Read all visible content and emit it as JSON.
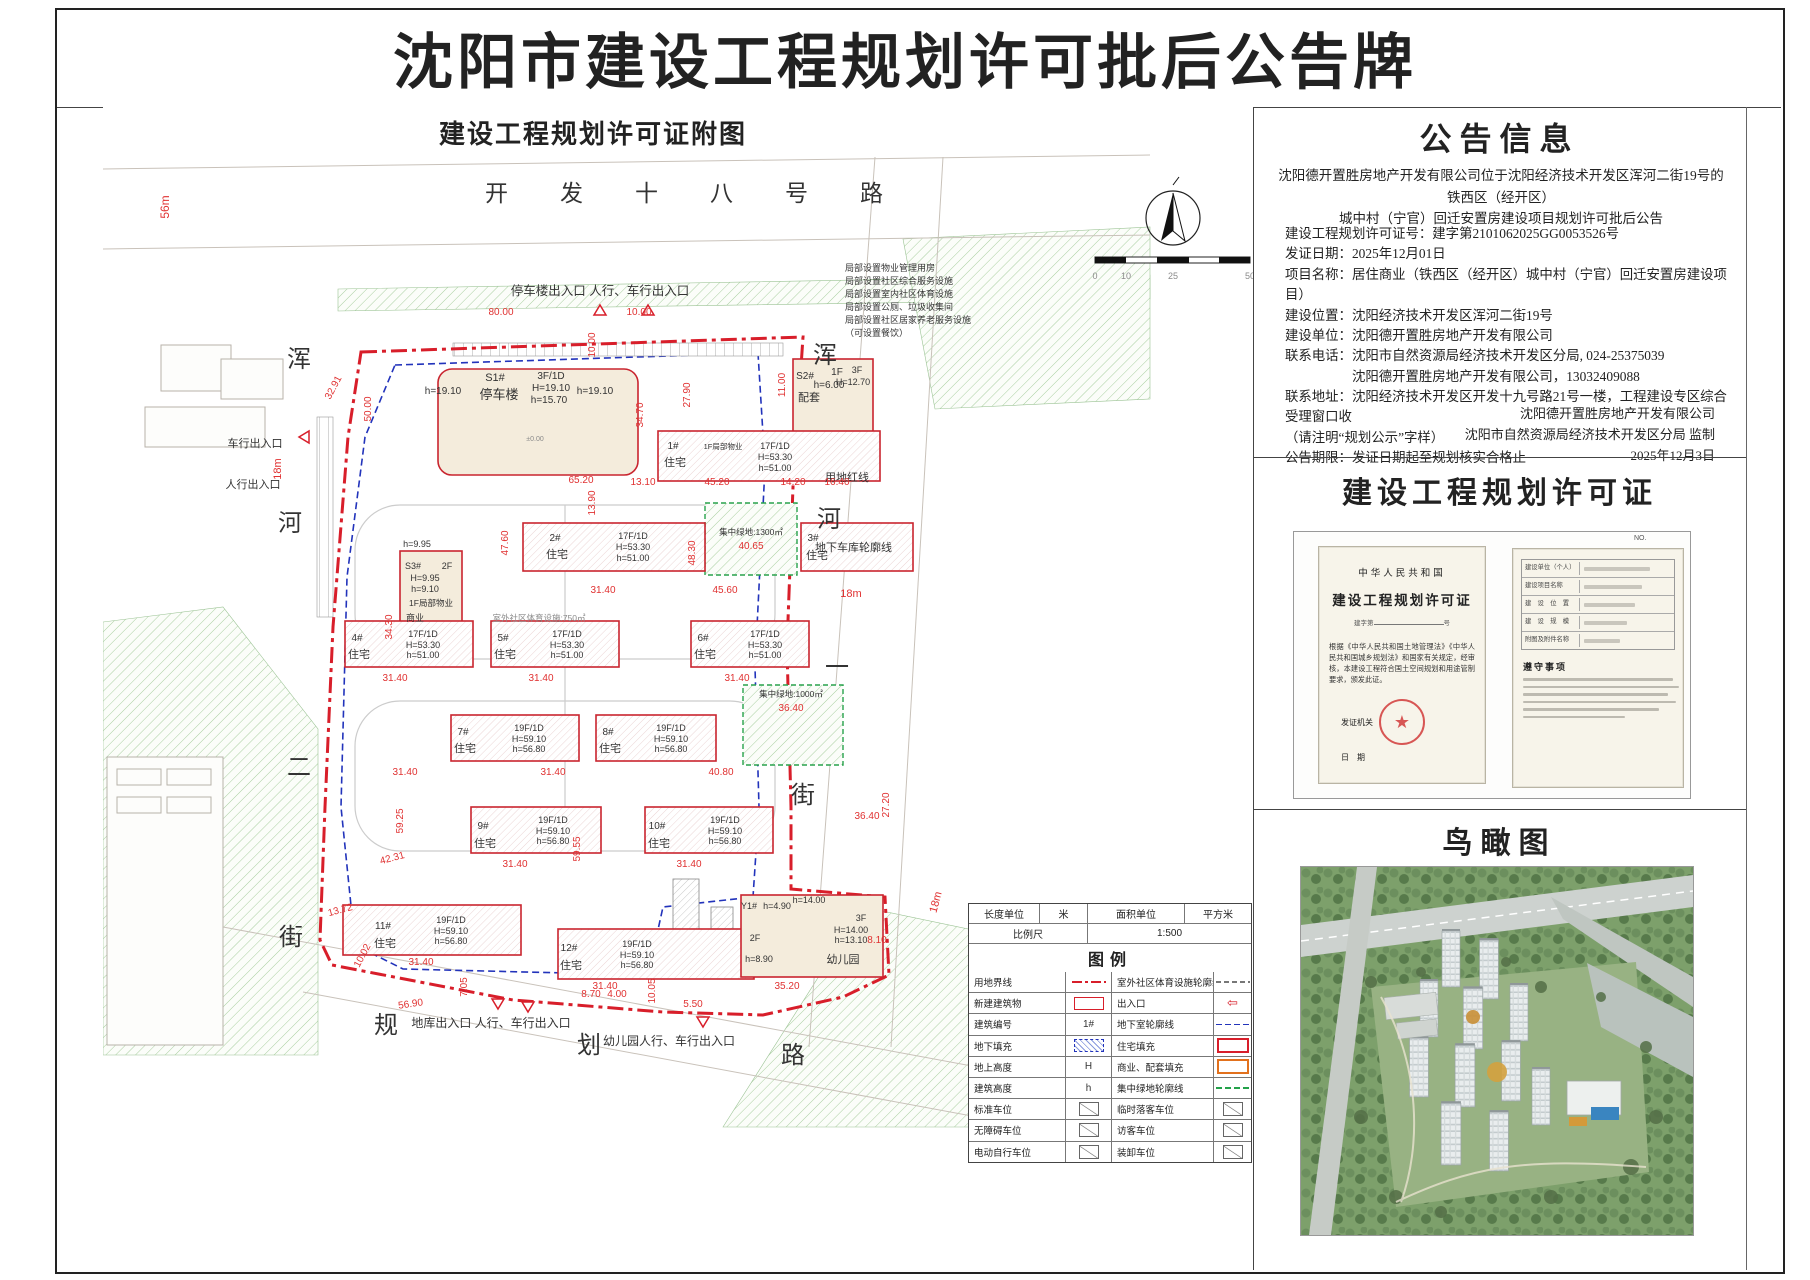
{
  "page": {
    "title": "沈阳市建设工程规划许可批后公告牌"
  },
  "map_panel": {
    "title": "建设工程规划许可证附图"
  },
  "icons": {
    "seal_star": "★",
    "entrance_arrow": "⇦"
  },
  "colors": {
    "boundary_red": "#d81e2a",
    "dim_red": "#e03131",
    "underground_blue": "#2233bb",
    "green_outline": "#1f8f43",
    "commercial_orange": "#e2711d"
  },
  "notice": {
    "title": "公告信息",
    "intro": [
      "沈阳德开置胜房地产开发有限公司位于沈阳经济技术开发区浑河二街19号的铁西区（经开区）",
      "城中村（宁官）回迁安置房建设项目规划许可批后公告"
    ],
    "lines": [
      "建设工程规划许可证号：建字第2101062025GG0053526号",
      "发证日期：2025年12月01日",
      "项目名称：居住商业（铁西区（经开区）城中村（宁官）回迁安置房建设项目）",
      "建设位置：沈阳经济技术开发区浑河二街19号",
      "建设单位：沈阳德开置胜房地产开发有限公司",
      "联系电话：沈阳市自然资源局经济技术开发区分局, 024-25375039",
      "　　　　　沈阳德开置胜房地产开发有限公司，13032409088",
      "联系地址：沈阳经济技术开发区开发十九号路21号一楼，工程建设专区综合受理窗口收",
      "（请注明“规划公示”字样）",
      "公告期限：发证日期起至规划核实合格止"
    ],
    "signature": [
      "沈阳德开置胜房地产开发有限公司",
      "沈阳市自然资源局经济技术开发区分局  监制",
      "2025年12月3日"
    ]
  },
  "permit": {
    "section_title": "建设工程规划许可证",
    "country": "中华人民共和国",
    "cert_title": "建设工程规划许可证",
    "number_prefix": "建字第",
    "number_suffix": "号",
    "no_label": "NO.",
    "body": "根据《中华人民共和国土地管理法》《中华人民共和国城乡规划法》和国家有关规定，经审核，本建设工程符合国土空间规划和用途管制要求，颁发此证。",
    "issuer_label": "发证机关",
    "date_label": "日　期",
    "fields": [
      "建设单位（个人）",
      "建设项目名称",
      "建　设　位　置",
      "建　设　规　模",
      "附图及附件名称"
    ],
    "rules_title": "遵守事项"
  },
  "aerial": {
    "title": "鸟瞰图"
  },
  "legend": {
    "units": {
      "len_label": "长度单位",
      "len_unit": "米",
      "area_label": "面积单位",
      "area_unit": "平方米",
      "scale_label": "比例尺",
      "scale_value": "1:500"
    },
    "section_title": "图例",
    "rows": [
      {
        "l": "用地界线",
        "ls": "line-red-dashdot",
        "r": "室外社区体育设施轮廓线",
        "rs": "line-gray-dash"
      },
      {
        "l": "新建建筑物",
        "ls": "rect-red",
        "r": "出入口",
        "rs": "arrow"
      },
      {
        "l": "建筑编号",
        "ls": "text",
        "lst": "1#",
        "r": "地下室轮廓线",
        "rs": "line-blue-dash"
      },
      {
        "l": "地下填充",
        "ls": "hatch-blue",
        "r": "住宅填充",
        "rs": "rect-red-thick"
      },
      {
        "l": "地上高度",
        "ls": "text",
        "lst": "H",
        "r": "商业、配套填充",
        "rs": "rect-orange"
      },
      {
        "l": "建筑高度",
        "ls": "text",
        "lst": "h",
        "r": "集中绿地轮廓线",
        "rs": "line-green-dash"
      },
      {
        "l": "标准车位",
        "ls": "park",
        "r": "临时落客车位",
        "rs": "park"
      },
      {
        "l": "无障碍车位",
        "ls": "park",
        "r": "访客车位",
        "rs": "park"
      },
      {
        "l": "电动自行车位",
        "ls": "park",
        "r": "装卸车位",
        "rs": "park"
      }
    ]
  },
  "site_plan": {
    "annotations": [
      {
        "t": "开发十八号路",
        "x": 382,
        "y": 94,
        "s": 23,
        "a": "start",
        "ls": 52
      },
      {
        "t": "56m",
        "x": 66,
        "y": 100,
        "s": 12,
        "c": "red",
        "r": -90
      },
      {
        "t": "浑",
        "x": 196,
        "y": 260,
        "s": 24
      },
      {
        "t": "河",
        "x": 187,
        "y": 424,
        "s": 24
      },
      {
        "t": "二",
        "x": 196,
        "y": 668,
        "s": 24
      },
      {
        "t": "街",
        "x": 188,
        "y": 838,
        "s": 24
      },
      {
        "t": "浑",
        "x": 722,
        "y": 256,
        "s": 24
      },
      {
        "t": "河",
        "x": 726,
        "y": 420,
        "s": 24
      },
      {
        "t": "一",
        "x": 734,
        "y": 568,
        "s": 24
      },
      {
        "t": "街",
        "x": 700,
        "y": 696,
        "s": 24
      },
      {
        "t": "规",
        "x": 283,
        "y": 926,
        "s": 24
      },
      {
        "t": "划",
        "x": 486,
        "y": 946,
        "s": 24
      },
      {
        "t": "路",
        "x": 690,
        "y": 956,
        "s": 24
      },
      {
        "t": "停车楼出入口  人行、车行出入口",
        "x": 497,
        "y": 188,
        "s": 12.5
      },
      {
        "t": "车行出入口",
        "x": 152,
        "y": 340,
        "s": 11
      },
      {
        "t": "人行出入口",
        "x": 150,
        "y": 381,
        "s": 11
      },
      {
        "t": "局部设置物业管理用房",
        "x": 742,
        "y": 164,
        "s": 9,
        "a": "start"
      },
      {
        "t": "局部设置社区综合服务设施",
        "x": 742,
        "y": 177,
        "s": 9,
        "a": "start"
      },
      {
        "t": "局部设置室内社区体育设施",
        "x": 742,
        "y": 190,
        "s": 9,
        "a": "start"
      },
      {
        "t": "局部设置公厕、垃圾收集间",
        "x": 742,
        "y": 203,
        "s": 9,
        "a": "start"
      },
      {
        "t": "局部设置社区居家养老服务设施",
        "x": 742,
        "y": 216,
        "s": 9,
        "a": "start"
      },
      {
        "t": "（可设置餐饮）",
        "x": 742,
        "y": 229,
        "s": 9,
        "a": "start"
      },
      {
        "t": "用地红线",
        "x": 722,
        "y": 374,
        "s": 11,
        "a": "start"
      },
      {
        "t": "地下车库轮廓线",
        "x": 712,
        "y": 444,
        "s": 11,
        "a": "start"
      },
      {
        "t": "18m",
        "x": 748,
        "y": 490,
        "s": 11,
        "c": "red"
      },
      {
        "t": "18m",
        "x": 178,
        "y": 362,
        "s": 11,
        "c": "red",
        "r": -90
      },
      {
        "t": "18m",
        "x": 836,
        "y": 796,
        "s": 11,
        "c": "red",
        "r": -75
      },
      {
        "t": "地库出入口  人行、车行出入口",
        "x": 388,
        "y": 920,
        "s": 12
      },
      {
        "t": "幼儿园人行、车行出入口",
        "x": 566,
        "y": 938,
        "s": 12
      },
      {
        "t": "80.00",
        "x": 398,
        "y": 208,
        "s": 10,
        "c": "red"
      },
      {
        "t": "10.00",
        "x": 536,
        "y": 208,
        "s": 10,
        "c": "red"
      },
      {
        "t": "10.00",
        "x": 492,
        "y": 238,
        "s": 10,
        "c": "red",
        "r": -90
      },
      {
        "t": "32.91",
        "x": 233,
        "y": 282,
        "s": 10,
        "c": "red",
        "r": -62
      },
      {
        "t": "50.00",
        "x": 268,
        "y": 302,
        "s": 10,
        "c": "red",
        "r": -90
      },
      {
        "t": "34.30",
        "x": 289,
        "y": 520,
        "s": 10,
        "c": "red",
        "r": -90
      },
      {
        "t": "34.70",
        "x": 540,
        "y": 308,
        "s": 10,
        "c": "red",
        "r": -90
      },
      {
        "t": "27.90",
        "x": 587,
        "y": 288,
        "s": 10,
        "c": "red",
        "r": -90
      },
      {
        "t": "11.00",
        "x": 682,
        "y": 278,
        "s": 10,
        "c": "red",
        "r": -90
      },
      {
        "t": "65.20",
        "x": 478,
        "y": 376,
        "s": 10,
        "c": "red"
      },
      {
        "t": "13.10",
        "x": 540,
        "y": 378,
        "s": 10,
        "c": "red"
      },
      {
        "t": "45.20",
        "x": 614,
        "y": 378,
        "s": 10,
        "c": "red"
      },
      {
        "t": "14.20",
        "x": 690,
        "y": 378,
        "s": 10,
        "c": "red"
      },
      {
        "t": "16.40",
        "x": 734,
        "y": 378,
        "s": 10,
        "c": "red"
      },
      {
        "t": "13.90",
        "x": 492,
        "y": 396,
        "s": 10,
        "c": "red",
        "r": -90
      },
      {
        "t": "47.60",
        "x": 405,
        "y": 436,
        "s": 10,
        "c": "red",
        "r": -90
      },
      {
        "t": "48.30",
        "x": 592,
        "y": 446,
        "s": 10,
        "c": "red",
        "r": -90
      },
      {
        "t": "31.40",
        "x": 500,
        "y": 486,
        "s": 10,
        "c": "red"
      },
      {
        "t": "45.60",
        "x": 622,
        "y": 486,
        "s": 10,
        "c": "red"
      },
      {
        "t": "40.65",
        "x": 648,
        "y": 442,
        "s": 10,
        "c": "red"
      },
      {
        "t": "集中绿地:1300㎡",
        "x": 648,
        "y": 428,
        "s": 8.5
      },
      {
        "t": "室外社区体育设施:750㎡",
        "x": 436,
        "y": 514,
        "s": 8.5,
        "c": "gray"
      },
      {
        "t": "31.40",
        "x": 292,
        "y": 574,
        "s": 10,
        "c": "red"
      },
      {
        "t": "31.40",
        "x": 438,
        "y": 574,
        "s": 10,
        "c": "red"
      },
      {
        "t": "31.40",
        "x": 634,
        "y": 574,
        "s": 10,
        "c": "red"
      },
      {
        "t": "31.40",
        "x": 302,
        "y": 668,
        "s": 10,
        "c": "red"
      },
      {
        "t": "31.40",
        "x": 450,
        "y": 668,
        "s": 10,
        "c": "red"
      },
      {
        "t": "40.80",
        "x": 618,
        "y": 668,
        "s": 10,
        "c": "red"
      },
      {
        "t": "集中绿地:1000㎡",
        "x": 688,
        "y": 590,
        "s": 8.5
      },
      {
        "t": "36.40",
        "x": 688,
        "y": 604,
        "s": 10,
        "c": "red"
      },
      {
        "t": "59.25",
        "x": 300,
        "y": 714,
        "s": 10,
        "c": "red",
        "r": -90
      },
      {
        "t": "59.55",
        "x": 477,
        "y": 742,
        "s": 10,
        "c": "red",
        "r": -90
      },
      {
        "t": "42.31",
        "x": 290,
        "y": 754,
        "s": 10,
        "c": "red",
        "r": -15
      },
      {
        "t": "31.40",
        "x": 412,
        "y": 760,
        "s": 10,
        "c": "red"
      },
      {
        "t": "31.40",
        "x": 586,
        "y": 760,
        "s": 10,
        "c": "red"
      },
      {
        "t": "27.20",
        "x": 786,
        "y": 698,
        "s": 10,
        "c": "red",
        "r": -90
      },
      {
        "t": "36.40",
        "x": 764,
        "y": 712,
        "s": 10,
        "c": "red"
      },
      {
        "t": "13.72",
        "x": 238,
        "y": 806,
        "s": 10,
        "c": "red",
        "r": -15
      },
      {
        "t": "10.02",
        "x": 262,
        "y": 850,
        "s": 10,
        "c": "red",
        "r": -62
      },
      {
        "t": "31.40",
        "x": 318,
        "y": 858,
        "s": 10,
        "c": "red"
      },
      {
        "t": "31.40",
        "x": 502,
        "y": 882,
        "s": 10,
        "c": "red"
      },
      {
        "t": "35.20",
        "x": 684,
        "y": 882,
        "s": 10,
        "c": "red"
      },
      {
        "t": "8.10",
        "x": 774,
        "y": 836,
        "s": 10,
        "c": "red"
      },
      {
        "t": "5.50",
        "x": 590,
        "y": 900,
        "s": 10,
        "c": "red"
      },
      {
        "t": "8.70",
        "x": 488,
        "y": 890,
        "s": 10,
        "c": "red"
      },
      {
        "t": "4.00",
        "x": 514,
        "y": 890,
        "s": 10,
        "c": "red"
      },
      {
        "t": "7.05",
        "x": 364,
        "y": 880,
        "s": 10,
        "c": "red",
        "r": -90
      },
      {
        "t": "10.05",
        "x": 552,
        "y": 884,
        "s": 10,
        "c": "red",
        "r": -90
      },
      {
        "t": "56.90",
        "x": 308,
        "y": 900,
        "s": 10,
        "c": "red",
        "r": -8
      },
      {
        "t": "S1#",
        "x": 392,
        "y": 274,
        "s": 11
      },
      {
        "t": "停车楼",
        "x": 396,
        "y": 292,
        "s": 13
      },
      {
        "t": "h=19.10",
        "x": 340,
        "y": 287,
        "s": 10
      },
      {
        "t": "3F/1D",
        "x": 448,
        "y": 272,
        "s": 10
      },
      {
        "t": "H=19.10",
        "x": 448,
        "y": 284,
        "s": 10
      },
      {
        "t": "h=15.70",
        "x": 446,
        "y": 296,
        "s": 10
      },
      {
        "t": "h=19.10",
        "x": 492,
        "y": 287,
        "s": 10
      },
      {
        "t": "±0.00",
        "x": 432,
        "y": 334,
        "s": 7,
        "c": "gray"
      },
      {
        "t": "S2#",
        "x": 702,
        "y": 272,
        "s": 10
      },
      {
        "t": "1F",
        "x": 734,
        "y": 268,
        "s": 10
      },
      {
        "t": "h=6.00",
        "x": 726,
        "y": 281,
        "s": 10
      },
      {
        "t": "配套",
        "x": 706,
        "y": 294,
        "s": 11
      },
      {
        "t": "3F",
        "x": 754,
        "y": 266,
        "s": 9
      },
      {
        "t": "H=12.70",
        "x": 750,
        "y": 278,
        "s": 9
      },
      {
        "t": "1#",
        "x": 570,
        "y": 342,
        "s": 10
      },
      {
        "t": "住宅",
        "x": 572,
        "y": 359,
        "s": 11
      },
      {
        "t": "1F局部物业",
        "x": 620,
        "y": 342,
        "s": 7.5
      },
      {
        "t": "17F/1D",
        "x": 672,
        "y": 342,
        "s": 9
      },
      {
        "t": "H=53.30",
        "x": 672,
        "y": 353,
        "s": 9
      },
      {
        "t": "h=51.00",
        "x": 672,
        "y": 364,
        "s": 9
      },
      {
        "t": "2#",
        "x": 452,
        "y": 434,
        "s": 10
      },
      {
        "t": "住宅",
        "x": 454,
        "y": 451,
        "s": 11
      },
      {
        "t": "17F/1D",
        "x": 530,
        "y": 432,
        "s": 9
      },
      {
        "t": "H=53.30",
        "x": 530,
        "y": 443,
        "s": 9
      },
      {
        "t": "h=51.00",
        "x": 530,
        "y": 454,
        "s": 9
      },
      {
        "t": "3#",
        "x": 710,
        "y": 434,
        "s": 10
      },
      {
        "t": "住宅",
        "x": 714,
        "y": 452,
        "s": 11
      },
      {
        "t": "S3#",
        "x": 310,
        "y": 462,
        "s": 9
      },
      {
        "t": "2F",
        "x": 344,
        "y": 462,
        "s": 9
      },
      {
        "t": "H=9.95",
        "x": 322,
        "y": 474,
        "s": 9
      },
      {
        "t": "h=9.10",
        "x": 322,
        "y": 485,
        "s": 9
      },
      {
        "t": "1F局部物业",
        "x": 328,
        "y": 499,
        "s": 8.5
      },
      {
        "t": "h=9.95",
        "x": 314,
        "y": 440,
        "s": 9
      },
      {
        "t": "商业",
        "x": 312,
        "y": 514,
        "s": 9
      },
      {
        "t": "4#",
        "x": 254,
        "y": 534,
        "s": 10
      },
      {
        "t": "住宅",
        "x": 256,
        "y": 551,
        "s": 11
      },
      {
        "t": "17F/1D",
        "x": 320,
        "y": 530,
        "s": 9
      },
      {
        "t": "H=53.30",
        "x": 320,
        "y": 541,
        "s": 9
      },
      {
        "t": "h=51.00",
        "x": 320,
        "y": 551,
        "s": 9
      },
      {
        "t": "5#",
        "x": 400,
        "y": 534,
        "s": 10
      },
      {
        "t": "住宅",
        "x": 402,
        "y": 551,
        "s": 11
      },
      {
        "t": "17F/1D",
        "x": 464,
        "y": 530,
        "s": 9
      },
      {
        "t": "H=53.30",
        "x": 464,
        "y": 541,
        "s": 9
      },
      {
        "t": "h=51.00",
        "x": 464,
        "y": 551,
        "s": 9
      },
      {
        "t": "6#",
        "x": 600,
        "y": 534,
        "s": 10
      },
      {
        "t": "住宅",
        "x": 602,
        "y": 551,
        "s": 11
      },
      {
        "t": "17F/1D",
        "x": 662,
        "y": 530,
        "s": 9
      },
      {
        "t": "H=53.30",
        "x": 662,
        "y": 541,
        "s": 9
      },
      {
        "t": "h=51.00",
        "x": 662,
        "y": 551,
        "s": 9
      },
      {
        "t": "7#",
        "x": 360,
        "y": 628,
        "s": 10
      },
      {
        "t": "住宅",
        "x": 362,
        "y": 645,
        "s": 11
      },
      {
        "t": "19F/1D",
        "x": 426,
        "y": 624,
        "s": 9
      },
      {
        "t": "H=59.10",
        "x": 426,
        "y": 635,
        "s": 9
      },
      {
        "t": "h=56.80",
        "x": 426,
        "y": 645,
        "s": 9
      },
      {
        "t": "8#",
        "x": 505,
        "y": 628,
        "s": 10
      },
      {
        "t": "住宅",
        "x": 507,
        "y": 645,
        "s": 11
      },
      {
        "t": "19F/1D",
        "x": 568,
        "y": 624,
        "s": 9
      },
      {
        "t": "H=59.10",
        "x": 568,
        "y": 635,
        "s": 9
      },
      {
        "t": "h=56.80",
        "x": 568,
        "y": 645,
        "s": 9
      },
      {
        "t": "9#",
        "x": 380,
        "y": 722,
        "s": 10
      },
      {
        "t": "住宅",
        "x": 382,
        "y": 740,
        "s": 11
      },
      {
        "t": "19F/1D",
        "x": 450,
        "y": 716,
        "s": 9
      },
      {
        "t": "H=59.10",
        "x": 450,
        "y": 727,
        "s": 9
      },
      {
        "t": "h=56.80",
        "x": 450,
        "y": 737,
        "s": 9
      },
      {
        "t": "10#",
        "x": 554,
        "y": 722,
        "s": 10
      },
      {
        "t": "住宅",
        "x": 556,
        "y": 740,
        "s": 11
      },
      {
        "t": "19F/1D",
        "x": 622,
        "y": 716,
        "s": 9
      },
      {
        "t": "H=59.10",
        "x": 622,
        "y": 727,
        "s": 9
      },
      {
        "t": "h=56.80",
        "x": 622,
        "y": 737,
        "s": 9
      },
      {
        "t": "11#",
        "x": 280,
        "y": 822,
        "s": 10
      },
      {
        "t": "住宅",
        "x": 282,
        "y": 840,
        "s": 11
      },
      {
        "t": "19F/1D",
        "x": 348,
        "y": 816,
        "s": 9
      },
      {
        "t": "H=59.10",
        "x": 348,
        "y": 827,
        "s": 9
      },
      {
        "t": "h=56.80",
        "x": 348,
        "y": 837,
        "s": 9
      },
      {
        "t": "12#",
        "x": 466,
        "y": 844,
        "s": 10
      },
      {
        "t": "住宅",
        "x": 468,
        "y": 862,
        "s": 11
      },
      {
        "t": "19F/1D",
        "x": 534,
        "y": 840,
        "s": 9
      },
      {
        "t": "H=59.10",
        "x": 534,
        "y": 851,
        "s": 9
      },
      {
        "t": "h=56.80",
        "x": 534,
        "y": 861,
        "s": 9
      },
      {
        "t": "Y1#",
        "x": 646,
        "y": 802,
        "s": 9
      },
      {
        "t": "h=4.90",
        "x": 674,
        "y": 802,
        "s": 9
      },
      {
        "t": "h=14.00",
        "x": 706,
        "y": 796,
        "s": 9
      },
      {
        "t": "2F",
        "x": 652,
        "y": 834,
        "s": 9
      },
      {
        "t": "3F",
        "x": 758,
        "y": 814,
        "s": 9
      },
      {
        "t": "H=14.00",
        "x": 748,
        "y": 826,
        "s": 9
      },
      {
        "t": "h=13.10",
        "x": 748,
        "y": 836,
        "s": 9
      },
      {
        "t": "h=8.90",
        "x": 656,
        "y": 855,
        "s": 9
      },
      {
        "t": "幼儿园",
        "x": 740,
        "y": 856,
        "s": 11
      },
      {
        "t": "0",
        "x": 992,
        "y": 172,
        "s": 9,
        "c": "gray"
      },
      {
        "t": "10",
        "x": 1023,
        "y": 172,
        "s": 9,
        "c": "gray"
      },
      {
        "t": "25",
        "x": 1070,
        "y": 172,
        "s": 9,
        "c": "gray"
      },
      {
        "t": "50",
        "x": 1147,
        "y": 172,
        "s": 9,
        "c": "gray"
      }
    ]
  }
}
